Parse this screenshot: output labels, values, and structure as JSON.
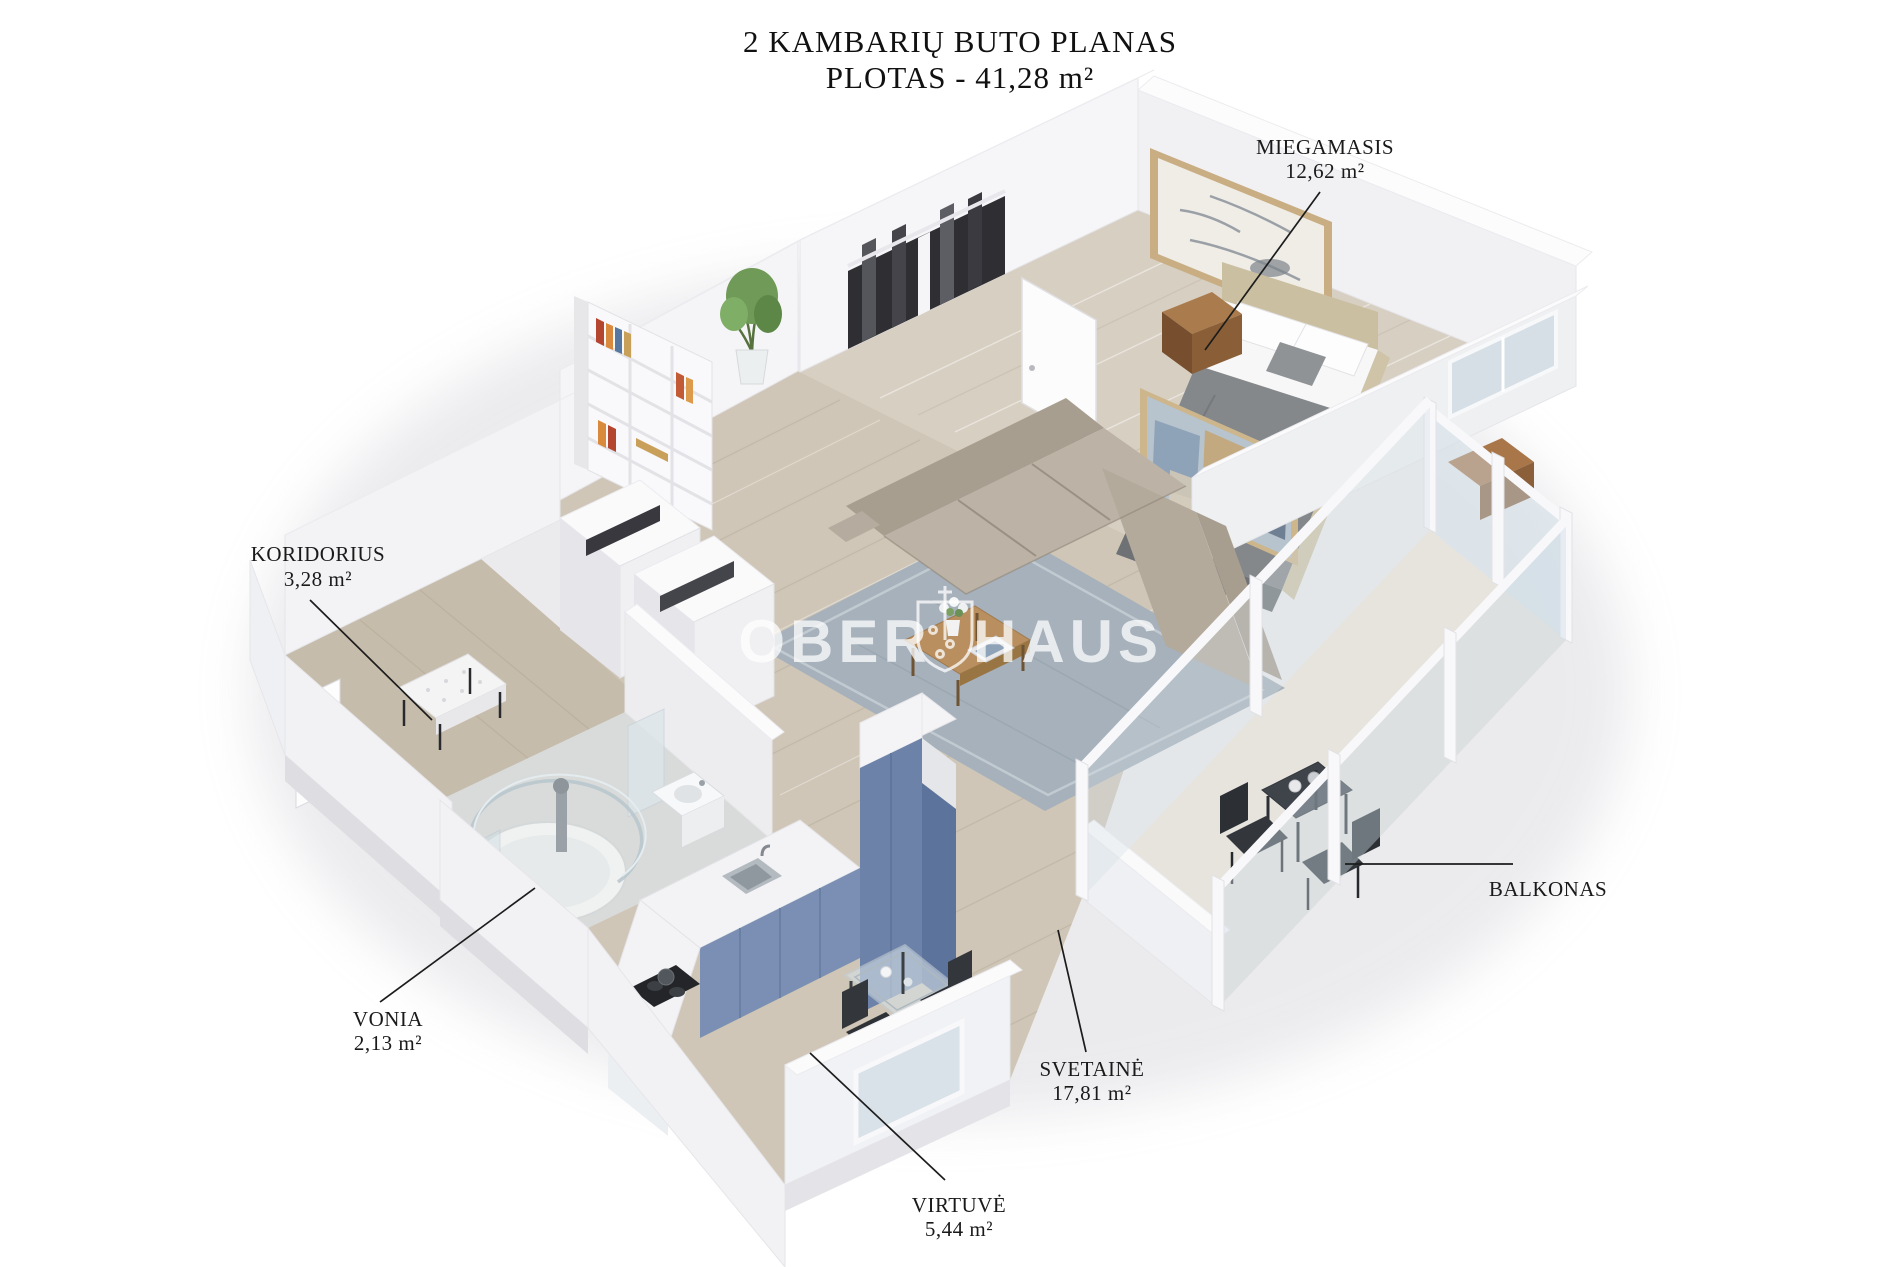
{
  "title": {
    "line1": "2 KAMBARIŲ BUTO PLANAS",
    "line2": "PLOTAS - 41,28 m²"
  },
  "watermark": {
    "left": "OBER",
    "right": "HAUS",
    "emblem": "shield-emblem"
  },
  "rooms": [
    {
      "id": "miegamasis",
      "name": "MIEGAMASIS",
      "area": "12,62 m²"
    },
    {
      "id": "koridorius",
      "name": "KORIDORIUS",
      "area": "3,28 m²"
    },
    {
      "id": "vonia",
      "name": "VONIA",
      "area": "2,13 m²"
    },
    {
      "id": "virtuve",
      "name": "VIRTUVĖ",
      "area": "5,44 m²"
    },
    {
      "id": "svetaine",
      "name": "SVETAINĖ",
      "area": "17,81 m²"
    },
    {
      "id": "balkonas",
      "name": "BALKONAS",
      "area": ""
    }
  ],
  "colors": {
    "kitchen_cabinet": "#7a8fb3",
    "sofa": "#b6ac9f",
    "rug": "#a6b1bb",
    "floor_wood": "#cfc6b7",
    "bedroom_floor": "#d7cfc2",
    "wall": "#f4f4f6",
    "label_text": "#1a1a1a",
    "watermark_text": "#ffffff"
  }
}
